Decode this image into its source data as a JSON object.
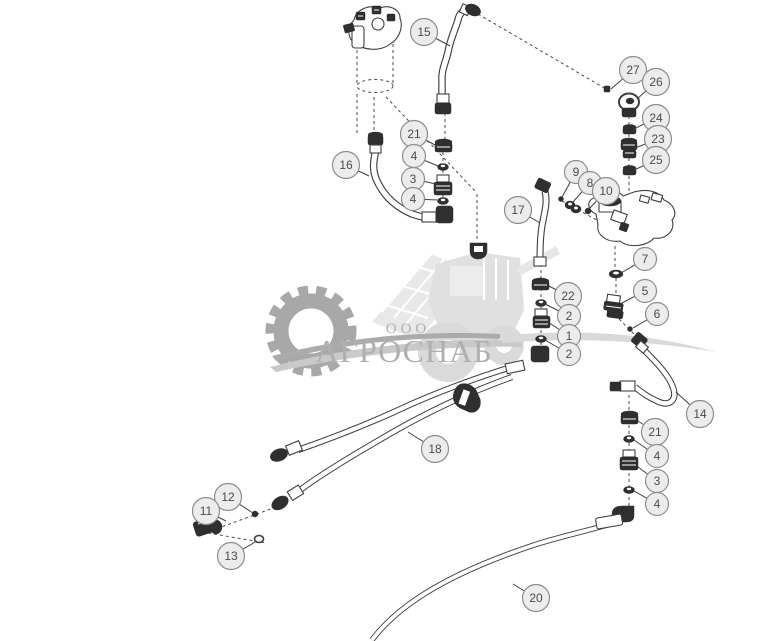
{
  "watermark": {
    "prefix": "ООО",
    "name": "АГРОСНАБ"
  },
  "colors": {
    "line": "#3f3f3f",
    "part_fill": "#2f2f2f",
    "callout_fill": "#ececec",
    "callout_stroke": "#8d8d8d",
    "callout_text": "#4b4b4b",
    "watermark_gear": "#a8a8a8",
    "watermark_machine": "#e2e2e2",
    "watermark_text": "#b0b0b0",
    "background": "#ffffff"
  },
  "callouts": [
    {
      "label": "15",
      "cx": 424,
      "cy": 32,
      "tx": 450,
      "ty": 46
    },
    {
      "label": "27",
      "cx": 633,
      "cy": 70,
      "tx": 611,
      "ty": 89
    },
    {
      "label": "26",
      "cx": 656,
      "cy": 82,
      "tx": 637,
      "ty": 99
    },
    {
      "label": "24",
      "cx": 656,
      "cy": 118,
      "tx": 634,
      "ty": 129
    },
    {
      "label": "23",
      "cx": 658,
      "cy": 139,
      "tx": 635,
      "ty": 148
    },
    {
      "label": "25",
      "cx": 656,
      "cy": 160,
      "tx": 634,
      "ty": 170
    },
    {
      "label": "16",
      "cx": 346,
      "cy": 165,
      "tx": 369,
      "ty": 176
    },
    {
      "label": "21",
      "cx": 414,
      "cy": 134,
      "tx": 437,
      "ty": 146
    },
    {
      "label": "4",
      "cx": 414,
      "cy": 156,
      "tx": 438,
      "ty": 166
    },
    {
      "label": "3",
      "cx": 413,
      "cy": 179,
      "tx": 436,
      "ty": 184
    },
    {
      "label": "4",
      "cx": 413,
      "cy": 199,
      "tx": 438,
      "ty": 200
    },
    {
      "label": "9",
      "cx": 576,
      "cy": 172,
      "tx": 562,
      "ty": 197
    },
    {
      "label": "8",
      "cx": 590,
      "cy": 183,
      "tx": 572,
      "ty": 203
    },
    {
      "label": "10",
      "cx": 606,
      "cy": 191,
      "tx": 588,
      "ty": 210
    },
    {
      "label": "17",
      "cx": 518,
      "cy": 210,
      "tx": 540,
      "ty": 223
    },
    {
      "label": "7",
      "cx": 645,
      "cy": 259,
      "tx": 621,
      "ty": 273
    },
    {
      "label": "22",
      "cx": 568,
      "cy": 296,
      "tx": 549,
      "ty": 286
    },
    {
      "label": "2",
      "cx": 569,
      "cy": 316,
      "tx": 545,
      "ty": 304
    },
    {
      "label": "1",
      "cx": 569,
      "cy": 336,
      "tx": 548,
      "ty": 322
    },
    {
      "label": "2",
      "cx": 569,
      "cy": 354,
      "tx": 545,
      "ty": 340
    },
    {
      "label": "5",
      "cx": 645,
      "cy": 291,
      "tx": 622,
      "ty": 303
    },
    {
      "label": "6",
      "cx": 657,
      "cy": 314,
      "tx": 633,
      "ty": 328
    },
    {
      "label": "14",
      "cx": 700,
      "cy": 414,
      "tx": 676,
      "ty": 392
    },
    {
      "label": "21",
      "cx": 655,
      "cy": 432,
      "tx": 638,
      "ty": 421
    },
    {
      "label": "4",
      "cx": 657,
      "cy": 456,
      "tx": 634,
      "ty": 440
    },
    {
      "label": "3",
      "cx": 657,
      "cy": 481,
      "tx": 638,
      "ty": 467
    },
    {
      "label": "4",
      "cx": 657,
      "cy": 504,
      "tx": 634,
      "ty": 491
    },
    {
      "label": "18",
      "cx": 435,
      "cy": 449,
      "tx": 408,
      "ty": 432
    },
    {
      "label": "12",
      "cx": 228,
      "cy": 497,
      "tx": 253,
      "ty": 513
    },
    {
      "label": "11",
      "cx": 206,
      "cy": 511,
      "tx": 226,
      "ty": 521
    },
    {
      "label": "13",
      "cx": 231,
      "cy": 556,
      "tx": 257,
      "ty": 541
    },
    {
      "label": "20",
      "cx": 536,
      "cy": 598,
      "tx": 513,
      "ty": 584
    }
  ]
}
